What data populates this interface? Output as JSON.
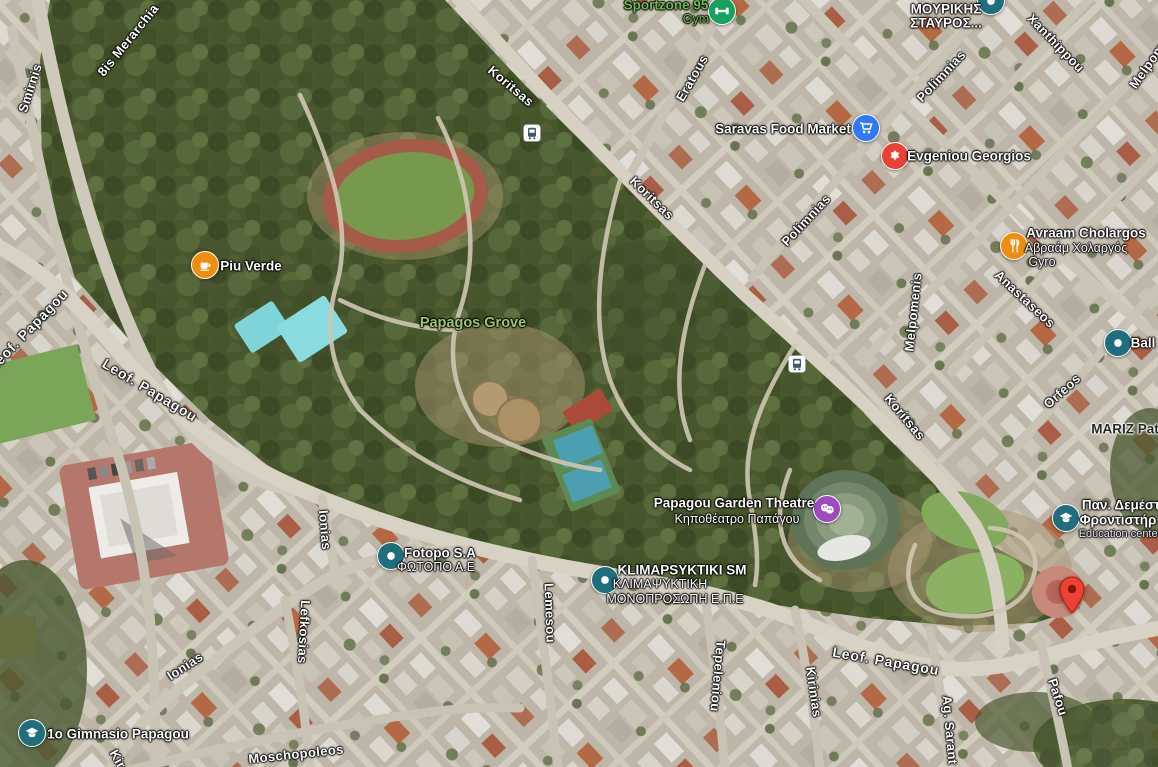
{
  "park": {
    "name": "Papagos Grove",
    "x": 473,
    "y": 323
  },
  "colors": {
    "street_label": "#ffffff",
    "park_label": "#9cc968",
    "business_green": "#6cba52",
    "poi_teal": "#1f6e7e",
    "poi_blue": "#3079f6",
    "poi_red": "#e94335",
    "poi_orange": "#ef8e0e",
    "poi_purple": "#9d4bbf",
    "poi_green": "#17a05e",
    "pin_red": "#ea4335",
    "bus_glyph": "#41586b"
  },
  "streets": [
    {
      "n": "Smirnis",
      "x": 30,
      "y": 88,
      "r": -72
    },
    {
      "n": "8is Merarchia",
      "x": 128,
      "y": 40,
      "r": -51
    },
    {
      "n": "Koritsas",
      "x": 511,
      "y": 86,
      "r": 40
    },
    {
      "n": "Koritsas",
      "x": 652,
      "y": 198,
      "r": 44
    },
    {
      "n": "Koritsas",
      "x": 905,
      "y": 417,
      "r": 50
    },
    {
      "n": "Eratous",
      "x": 692,
      "y": 78,
      "r": -60
    },
    {
      "n": "Xanthippou",
      "x": 1056,
      "y": 43,
      "r": 46
    },
    {
      "n": "Polimnias",
      "x": 941,
      "y": 76,
      "r": -47
    },
    {
      "n": "Polimnias",
      "x": 806,
      "y": 220,
      "r": -47
    },
    {
      "n": "Melpomenis",
      "x": 913,
      "y": 312,
      "r": -84
    },
    {
      "n": "Melpom",
      "x": 1147,
      "y": 66,
      "r": -55
    },
    {
      "n": "Anastaseos",
      "x": 1025,
      "y": 299,
      "r": 43
    },
    {
      "n": "Orfeos",
      "x": 1062,
      "y": 391,
      "r": -42
    },
    {
      "n": "Leof. Papagou",
      "x": 28,
      "y": 330,
      "r": -46,
      "main": true
    },
    {
      "n": "Leof. Papagou",
      "x": 150,
      "y": 390,
      "r": 31,
      "main": true
    },
    {
      "n": "Leof. Papagou",
      "x": 886,
      "y": 661,
      "r": 10,
      "main": true
    },
    {
      "n": "Ionias",
      "x": 325,
      "y": 530,
      "r": 85
    },
    {
      "n": "Ionias",
      "x": 185,
      "y": 666,
      "r": -33
    },
    {
      "n": "Lefkosias",
      "x": 304,
      "y": 632,
      "r": 93
    },
    {
      "n": "Moschopoleos",
      "x": 296,
      "y": 754,
      "r": -6
    },
    {
      "n": "Lemesou",
      "x": 550,
      "y": 613,
      "r": 88
    },
    {
      "n": "Tepeleniou",
      "x": 718,
      "y": 676,
      "r": 95
    },
    {
      "n": "Kirinias",
      "x": 814,
      "y": 692,
      "r": 82
    },
    {
      "n": "Ag. Sarant",
      "x": 950,
      "y": 730,
      "r": 85
    },
    {
      "n": "Pafou",
      "x": 1058,
      "y": 697,
      "r": 72
    },
    {
      "n": "Kir",
      "x": 118,
      "y": 759,
      "r": 60
    }
  ],
  "pois": [
    {
      "id": "sportzone-95",
      "glyph": "gym",
      "color": "#17a05e",
      "icon": {
        "x": 722,
        "y": 11
      },
      "lines": [
        {
          "t": "Sportzone 95",
          "x": 666,
          "y": 5,
          "s": "green-name"
        },
        {
          "t": "Gym",
          "x": 696,
          "y": 19,
          "s": "green-sub"
        }
      ]
    },
    {
      "id": "mourikis-stavros",
      "glyph": "dot",
      "color": "#1f6e7e",
      "icon": {
        "x": 991,
        "y": 1
      },
      "lines": [
        {
          "t": "ΜΟΥΡΙΚΗΣ",
          "x": 946,
          "y": 9,
          "s": "name"
        },
        {
          "t": "ΣΤΑΥΡΟΣ...",
          "x": 946,
          "y": 23,
          "s": "name"
        }
      ]
    },
    {
      "id": "saravas-food-market",
      "glyph": "cart",
      "color": "#3079f6",
      "icon": {
        "x": 866,
        "y": 128
      },
      "lines": [
        {
          "t": "Saravas Food Market",
          "x": 783,
          "y": 129,
          "s": "name"
        }
      ]
    },
    {
      "id": "evgeniou-georgios",
      "glyph": "badge",
      "color": "#e94335",
      "icon": {
        "x": 895,
        "y": 156
      },
      "lines": [
        {
          "t": "Evgeniou Georgios",
          "x": 969,
          "y": 156,
          "s": "name"
        }
      ]
    },
    {
      "id": "avraam-cholargos",
      "glyph": "restaurant",
      "color": "#ef8e0e",
      "icon": {
        "x": 1014,
        "y": 246
      },
      "lines": [
        {
          "t": "Avraam Cholargos",
          "x": 1086,
          "y": 233,
          "s": "name"
        },
        {
          "t": "Αβραάμ Χολαργός",
          "x": 1076,
          "y": 248,
          "s": "sub"
        },
        {
          "t": "Gyro",
          "x": 1042,
          "y": 262,
          "s": "sub"
        }
      ]
    },
    {
      "id": "piu-verde",
      "glyph": "cafe",
      "color": "#ef8e0e",
      "icon": {
        "x": 205,
        "y": 265
      },
      "lines": [
        {
          "t": "Piu Verde",
          "x": 251,
          "y": 266,
          "s": "name"
        }
      ]
    },
    {
      "id": "ball",
      "glyph": "dot",
      "color": "#1f6e7e",
      "icon": {
        "x": 1118,
        "y": 343
      },
      "lines": [
        {
          "t": "Ball",
          "x": 1143,
          "y": 343,
          "s": "name"
        }
      ]
    },
    {
      "id": "mariz",
      "glyph": "none",
      "color": "",
      "lines": [
        {
          "t": "MARIZ Pat",
          "x": 1125,
          "y": 429,
          "s": "dark-name"
        }
      ]
    },
    {
      "id": "papagou-garden-theatre",
      "glyph": "theater",
      "color": "#9d4bbf",
      "icon": {
        "x": 827,
        "y": 509
      },
      "lines": [
        {
          "t": "Papagou Garden Theatre",
          "x": 734,
          "y": 503,
          "s": "name"
        },
        {
          "t": "Κηποθέατρο Παπάγου",
          "x": 737,
          "y": 519,
          "s": "sub"
        }
      ]
    },
    {
      "id": "pan-demest-education-center",
      "glyph": "school",
      "color": "#1f6e7e",
      "icon": {
        "x": 1066,
        "y": 518
      },
      "lines": [
        {
          "t": "Παν. Δεμέστ",
          "x": 1121,
          "y": 505,
          "s": "name"
        },
        {
          "t": "Φροντιστήρ",
          "x": 1118,
          "y": 520,
          "s": "name"
        },
        {
          "t": "Education center",
          "x": 1120,
          "y": 534,
          "s": "small-sub"
        }
      ]
    },
    {
      "id": "fotopo-sa",
      "glyph": "dot",
      "color": "#1f6e7e",
      "icon": {
        "x": 391,
        "y": 556
      },
      "lines": [
        {
          "t": "Fotopo S.A",
          "x": 440,
          "y": 553,
          "s": "name"
        },
        {
          "t": "ΦΩΤΟΠΟ Α.Ε",
          "x": 436,
          "y": 567,
          "s": "sub"
        }
      ]
    },
    {
      "id": "klimapsyktiki-sm",
      "glyph": "dot",
      "color": "#1f6e7e",
      "icon": {
        "x": 605,
        "y": 580
      },
      "lines": [
        {
          "t": "KLIMAPSYKTIKI SM",
          "x": 682,
          "y": 570,
          "s": "name"
        },
        {
          "t": "ΚΛΙΜΑΨΥΚΤΙΚΗ",
          "x": 660,
          "y": 584,
          "s": "sub"
        },
        {
          "t": "ΜΟΝΟΠΡΟΣΩΠΗ Ε.Π.Ε",
          "x": 675,
          "y": 599,
          "s": "sub"
        }
      ]
    },
    {
      "id": "1o-gimnasio-papagou",
      "glyph": "school",
      "color": "#1f6e7e",
      "icon": {
        "x": 32,
        "y": 733
      },
      "lines": [
        {
          "t": "1o Gimnasio Papagou",
          "x": 118,
          "y": 734,
          "s": "name"
        }
      ]
    }
  ],
  "transit_stops": [
    {
      "x": 532,
      "y": 133
    },
    {
      "x": 797,
      "y": 364
    }
  ],
  "destination_pin": {
    "x": 1072,
    "y": 614
  }
}
